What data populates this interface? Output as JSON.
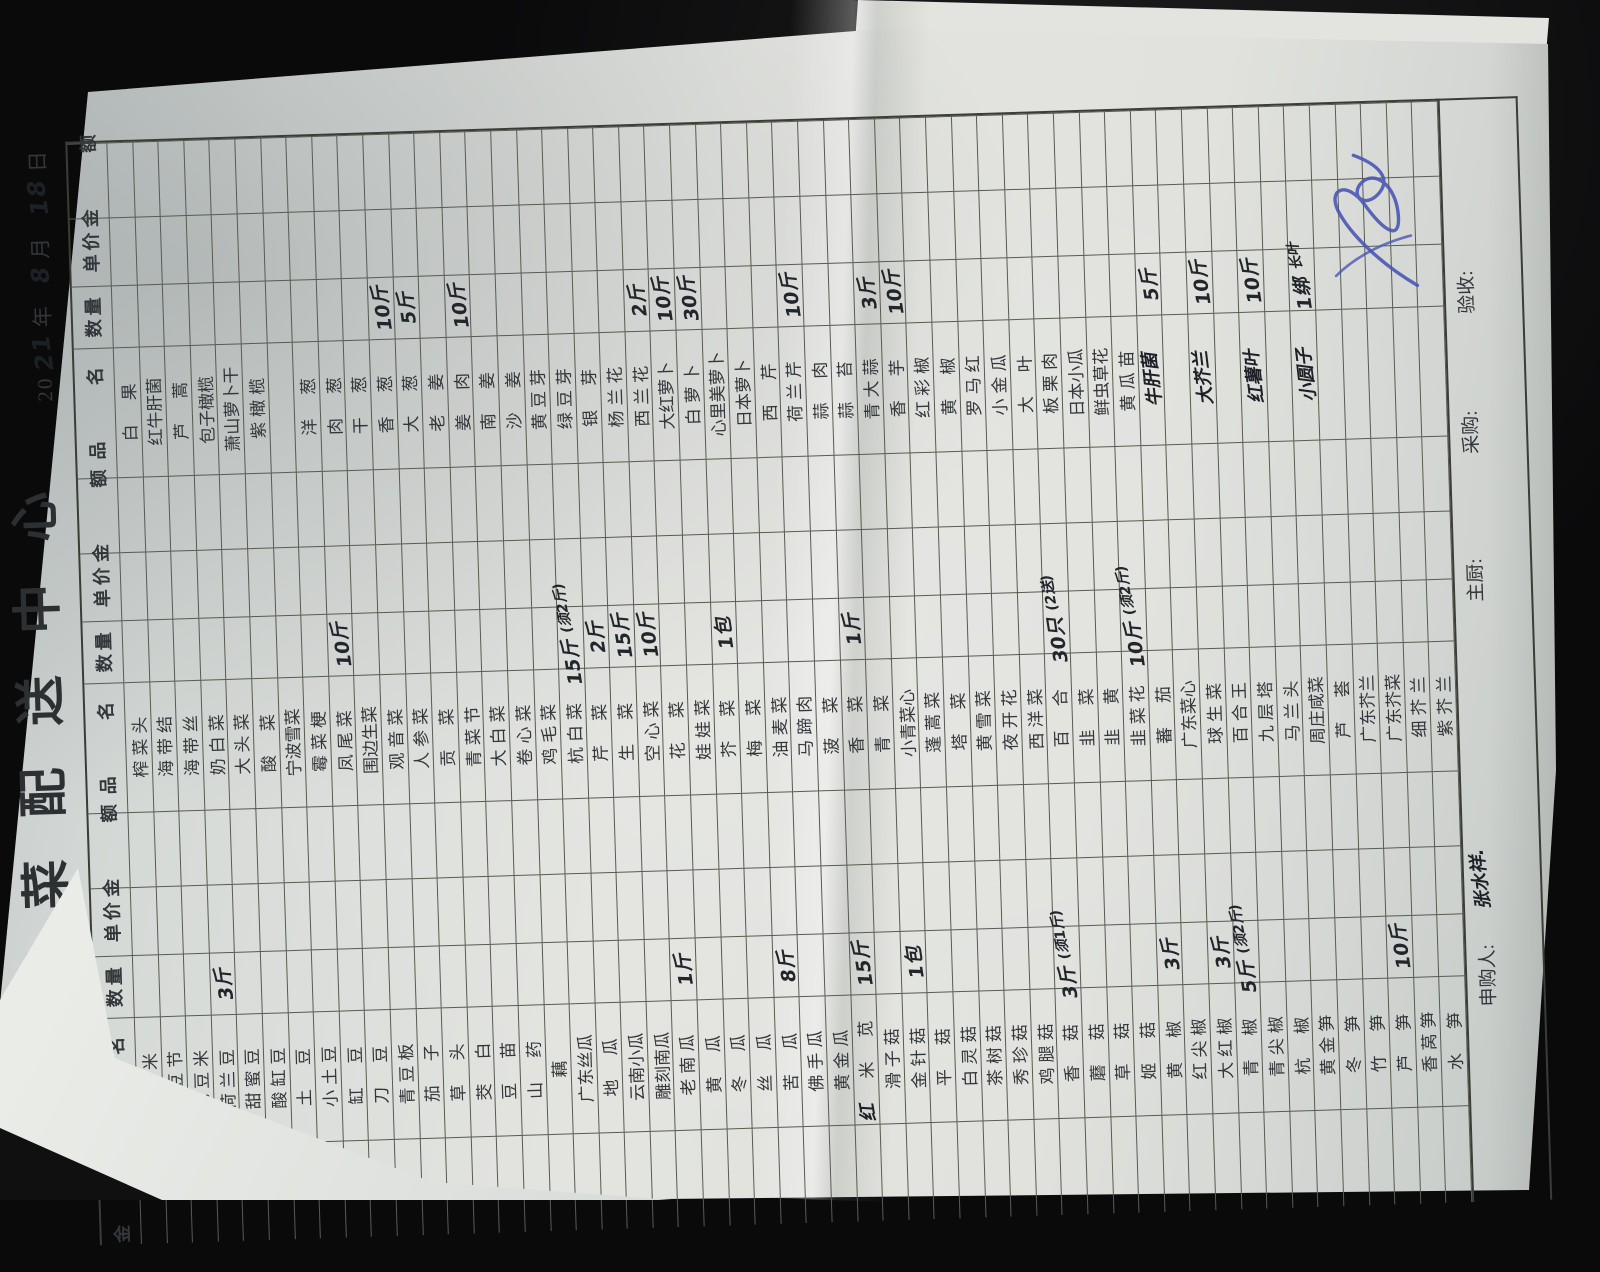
{
  "scene": {
    "background": "#0a0a0b",
    "paper_color": "#dfe1dd",
    "ink_blue": "#4a57b5",
    "ink_black": "#1d2026"
  },
  "form": {
    "title": "蔬菜配送中心",
    "date": {
      "prefix": "20",
      "year_hw": "21",
      "year_label": "年",
      "month_hw": "8",
      "month_label": "月",
      "day_hw": "18",
      "day_label": "日"
    },
    "header": {
      "name": "品 名",
      "qty": "数量",
      "price": "单价",
      "amount": "金 额"
    },
    "groups": [
      {
        "rows": [
          {
            "n": "玉米"
          },
          {
            "n": "毛豆节"
          },
          {
            "n": "毛豆米"
          },
          {
            "n": "荷兰豆",
            "q": "3斤"
          },
          {
            "n": "甜蜜豆"
          },
          {
            "n": "酸缸豆"
          },
          {
            "n": "土豆"
          },
          {
            "n": "小土豆"
          },
          {
            "n": "缸豆"
          },
          {
            "n": "刀豆"
          },
          {
            "n": "青豆板"
          },
          {
            "n": "茄子"
          },
          {
            "n": "草头"
          },
          {
            "n": "茭白"
          },
          {
            "n": "豆苗"
          },
          {
            "n": "山药"
          },
          {
            "n": "藕"
          },
          {
            "n": "广东丝瓜"
          },
          {
            "n": "地瓜"
          },
          {
            "n": "云南小瓜"
          },
          {
            "n": "雕刻南瓜"
          },
          {
            "n": "老南瓜",
            "q": "1斤"
          },
          {
            "n": "黄瓜"
          },
          {
            "n": "冬瓜"
          },
          {
            "n": "丝瓜"
          },
          {
            "n": "苦瓜",
            "q": "8斤"
          },
          {
            "n": "佛手瓜"
          },
          {
            "n": "黄金瓜"
          },
          {
            "n": "米苋",
            "p": "红",
            "q": "15斤"
          },
          {
            "n": "滑子菇"
          },
          {
            "n": "金针菇",
            "q": "1包"
          },
          {
            "n": "平菇"
          },
          {
            "n": "白灵菇"
          },
          {
            "n": "茶树菇"
          },
          {
            "n": "秀珍菇"
          },
          {
            "n": "鸡腿菇"
          },
          {
            "n": "香菇",
            "q": "3斤",
            "t": "(须1斤)"
          },
          {
            "n": "蘑菇"
          },
          {
            "n": "草菇"
          },
          {
            "n": "姬菇"
          },
          {
            "n": "黄椒",
            "q": "3斤"
          },
          {
            "n": "红尖椒"
          },
          {
            "n": "大红椒",
            "q": "3斤"
          },
          {
            "n": "青椒",
            "q": "5斤",
            "t": "(须2斤)"
          },
          {
            "n": "青尖椒"
          },
          {
            "n": "杭椒"
          },
          {
            "n": "黄金笋"
          },
          {
            "n": "冬笋"
          },
          {
            "n": "竹笋"
          },
          {
            "n": "芦笋",
            "q": "10斤"
          },
          {
            "n": "香莴笋"
          },
          {
            "n": "水笋"
          }
        ]
      },
      {
        "rows": [
          {
            "n": "榨菜头"
          },
          {
            "n": "海带结"
          },
          {
            "n": "海带丝"
          },
          {
            "n": "奶白菜"
          },
          {
            "n": "大头菜"
          },
          {
            "n": "酸菜"
          },
          {
            "n": "宁波雪菜"
          },
          {
            "n": "霉菜梗"
          },
          {
            "n": "凤尾菜",
            "q": "10斤"
          },
          {
            "n": "围边生菜"
          },
          {
            "n": "观音菜"
          },
          {
            "n": "人参菜"
          },
          {
            "n": "贡菜"
          },
          {
            "n": "青菜节"
          },
          {
            "n": "大白菜"
          },
          {
            "n": "卷心菜"
          },
          {
            "n": "鸡毛菜"
          },
          {
            "n": "杭白菜",
            "q": "15斤",
            "t": "(须2斤)"
          },
          {
            "n": "芹菜",
            "q": "2斤"
          },
          {
            "n": "生菜",
            "q": "15斤"
          },
          {
            "n": "空心菜",
            "q": "10斤"
          },
          {
            "n": "花菜"
          },
          {
            "n": "娃娃菜"
          },
          {
            "n": "芥菜",
            "q": "1包"
          },
          {
            "n": "梅菜"
          },
          {
            "n": "油麦菜"
          },
          {
            "n": "马蹄肉"
          },
          {
            "n": "菠菜"
          },
          {
            "n": "香菜",
            "q": "1斤"
          },
          {
            "n": "青菜"
          },
          {
            "n": "小青菜心"
          },
          {
            "n": "蓬蒿菜"
          },
          {
            "n": "塔菜"
          },
          {
            "n": "黄雪菜"
          },
          {
            "n": "夜开花"
          },
          {
            "n": "西洋菜"
          },
          {
            "n": "百合",
            "q": "30只",
            "t": "(2送)"
          },
          {
            "n": "韭菜"
          },
          {
            "n": "韭黄"
          },
          {
            "n": "韭菜花",
            "q": "10斤",
            "t": "(须2斤)"
          },
          {
            "n": "蕃茄"
          },
          {
            "n": "广东菜心"
          },
          {
            "n": "球生菜"
          },
          {
            "n": "百合王"
          },
          {
            "n": "九层塔"
          },
          {
            "n": "马兰头"
          },
          {
            "n": "周庄咸菜"
          },
          {
            "n": "芦荟"
          },
          {
            "n": "广东芥兰"
          },
          {
            "n": "广东芥菜"
          },
          {
            "n": "细芥兰"
          },
          {
            "n": "紫芥兰"
          }
        ]
      },
      {
        "rows": [
          {
            "n": "白果"
          },
          {
            "n": "红牛肝菌"
          },
          {
            "n": "芦蒿"
          },
          {
            "n": "包子橄榄"
          },
          {
            "n": "萧山萝卜干"
          },
          {
            "n": "紫橄榄"
          },
          {
            "n": ""
          },
          {
            "n": "洋葱"
          },
          {
            "n": "肉葱"
          },
          {
            "n": "干葱"
          },
          {
            "n": "香葱",
            "q": "10斤"
          },
          {
            "n": "大葱",
            "q": "5斤"
          },
          {
            "n": "老姜"
          },
          {
            "n": "姜肉",
            "q": "10斤"
          },
          {
            "n": "南姜"
          },
          {
            "n": "沙姜"
          },
          {
            "n": "黄豆芽"
          },
          {
            "n": "绿豆芽"
          },
          {
            "n": "银芽"
          },
          {
            "n": "杨兰花"
          },
          {
            "n": "西兰花",
            "q": "2斤"
          },
          {
            "n": "大红萝卜",
            "q": "10斤"
          },
          {
            "n": "白萝卜",
            "q": "30斤"
          },
          {
            "n": "心里美萝卜"
          },
          {
            "n": "日本萝卜"
          },
          {
            "n": "西芹"
          },
          {
            "n": "荷兰芹",
            "q": "10斤"
          },
          {
            "n": "蒜肉"
          },
          {
            "n": "蒜苔"
          },
          {
            "n": "青大蒜",
            "q": "3斤"
          },
          {
            "n": "香芋",
            "q": "10斤",
            "x": true
          },
          {
            "n": "红彩椒"
          },
          {
            "n": "黄椒"
          },
          {
            "n": "罗马红"
          },
          {
            "n": "小金瓜"
          },
          {
            "n": "大叶"
          },
          {
            "n": "板栗肉"
          },
          {
            "n": "日本小瓜"
          },
          {
            "n": "鲜虫草花"
          },
          {
            "n": "黄瓜苗"
          },
          {
            "n": "牛肝菌",
            "h": true,
            "q": "5斤"
          },
          {
            "n": ""
          },
          {
            "n": "大芥兰",
            "h": true,
            "q": "10斤"
          },
          {
            "n": ""
          },
          {
            "n": "红薯叶",
            "h": true,
            "q": "10斤"
          },
          {
            "n": ""
          },
          {
            "n": "小圆子",
            "h": true,
            "q": "1绑",
            "t": "长叶"
          },
          {
            "n": ""
          },
          {
            "n": ""
          },
          {
            "n": ""
          },
          {
            "n": ""
          },
          {
            "n": ""
          }
        ]
      }
    ],
    "footer": {
      "requester_label": "申购人:",
      "requester_name": "张水祥.",
      "chef_label": "主厨:",
      "buyer_label": "采购:",
      "inspector_label": "验收:"
    }
  }
}
